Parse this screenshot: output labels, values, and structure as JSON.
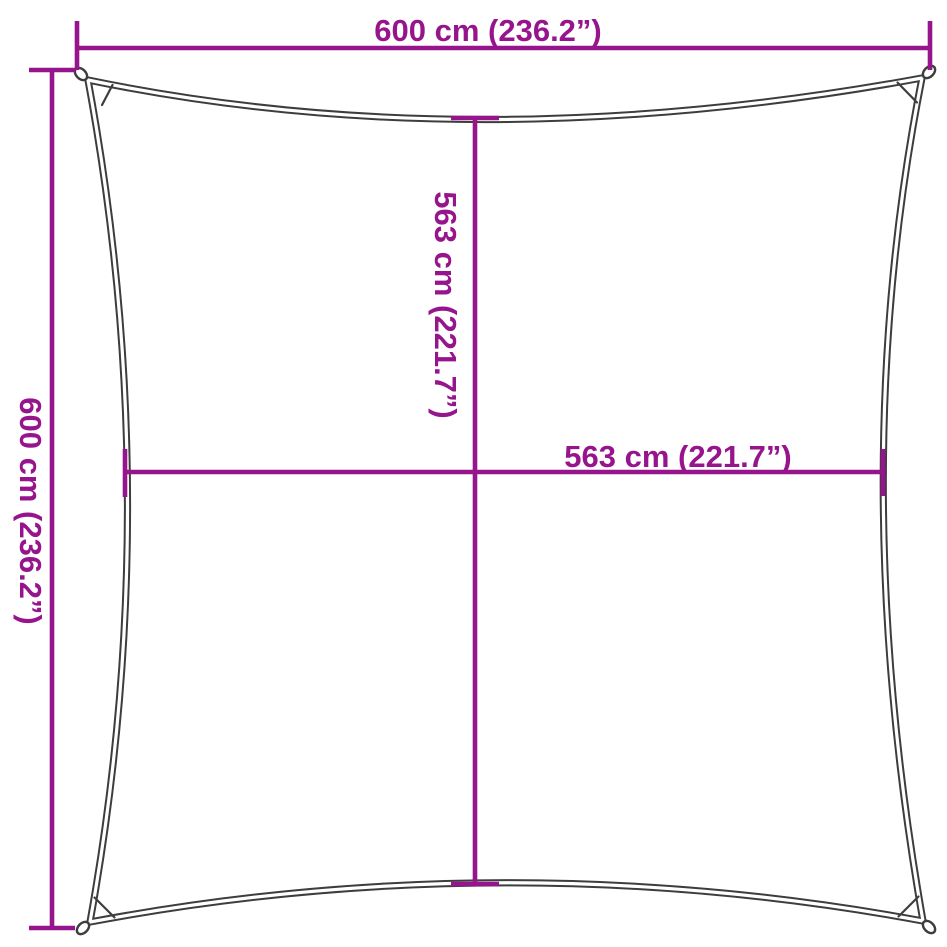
{
  "colors": {
    "dimension": "#97158C",
    "outline": "#3D3D3D",
    "background": "#FFFFFF"
  },
  "dimensions": {
    "top_width": {
      "label": "600 cm (236.2”)"
    },
    "left_height": {
      "label": "600 cm (236.2”)"
    },
    "center_height": {
      "label": "563 cm (221.7”)"
    },
    "center_width": {
      "label": "563 cm (221.7”)"
    }
  }
}
